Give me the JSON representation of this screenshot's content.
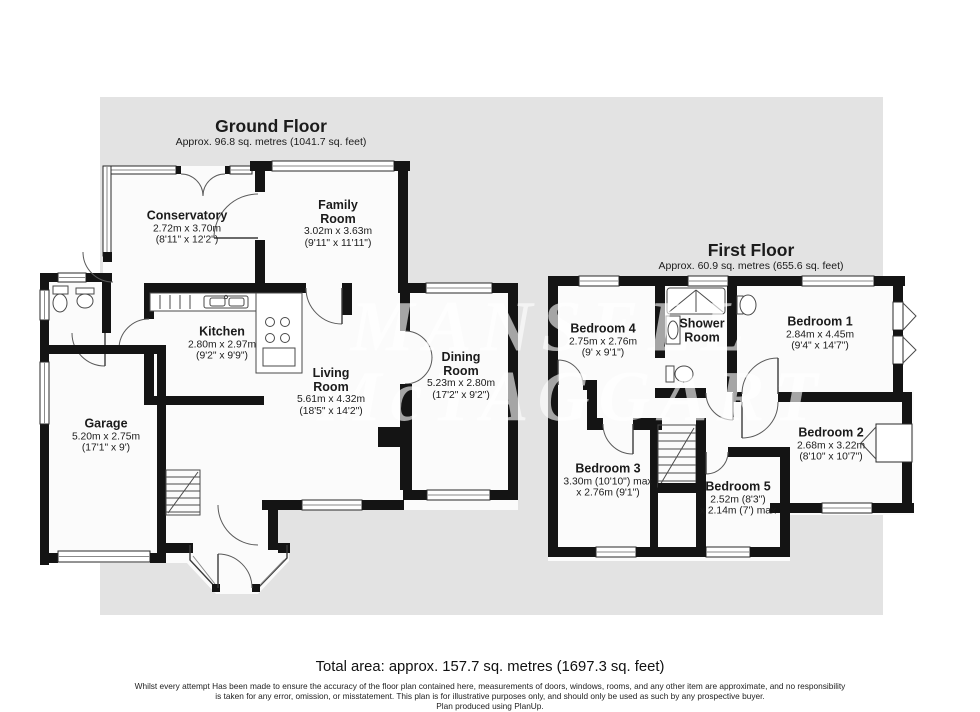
{
  "page": {
    "plan_bg": "#e3e3e3",
    "wall": "#141414"
  },
  "watermark": {
    "line1": "MANSELL",
    "line2": "McTAGGART"
  },
  "ground_floor": {
    "title": "Ground Floor",
    "subtitle": "Approx. 96.8 sq. metres (1041.7 sq. feet)",
    "rooms": {
      "conservatory": {
        "name": "Conservatory",
        "metric": "2.72m x 3.70m",
        "imperial": "(8'11\" x 12'2\")"
      },
      "family_room": {
        "name": "Family Room",
        "metric": "3.02m x 3.63m",
        "imperial": "(9'11\" x 11'11\")"
      },
      "kitchen": {
        "name": "Kitchen",
        "metric": "2.80m x 2.97m",
        "imperial": "(9'2\" x 9'9\")"
      },
      "living_room": {
        "name": "Living Room",
        "metric": "5.61m x 4.32m",
        "imperial": "(18'5\" x 14'2\")"
      },
      "dining_room": {
        "name": "Dining Room",
        "metric": "5.23m x 2.80m",
        "imperial": "(17'2\" x 9'2\")"
      },
      "garage": {
        "name": "Garage",
        "metric": "5.20m x 2.75m",
        "imperial": "(17'1\" x 9')"
      }
    }
  },
  "first_floor": {
    "title": "First Floor",
    "subtitle": "Approx. 60.9 sq. metres (655.6 sq. feet)",
    "rooms": {
      "bedroom_4": {
        "name": "Bedroom 4",
        "metric": "2.75m x 2.76m",
        "imperial": "(9' x 9'1\")"
      },
      "shower_room": {
        "name": "Shower Room"
      },
      "bedroom_1": {
        "name": "Bedroom 1",
        "metric": "2.84m x 4.45m",
        "imperial": "(9'4\" x 14'7\")"
      },
      "bedroom_2": {
        "name": "Bedroom 2",
        "metric": "2.68m x 3.22m",
        "imperial": "(8'10\" x 10'7\")"
      },
      "bedroom_3": {
        "name": "Bedroom 3",
        "metric": "3.30m (10'10\") max",
        "imperial": "x 2.76m (9'1\")"
      },
      "bedroom_5": {
        "name": "Bedroom 5",
        "metric": "2.52m (8'3\")",
        "imperial": "x 2.14m (7') max"
      }
    }
  },
  "footer": {
    "total_area": "Total area: approx. 157.7 sq. metres (1697.3 sq. feet)",
    "disclaimer_line1": "Whilst every attempt Has been made to ensure the accuracy of the floor plan contained here, measurements of doors, windows, rooms, and any other item are approximate, and no responsibility",
    "disclaimer_line2": "is taken for any error, omission, or misstatement. This plan is for illustrative purposes only, and should only be used as such by any prospective buyer.",
    "disclaimer_line3": "Plan produced using PlanUp."
  }
}
